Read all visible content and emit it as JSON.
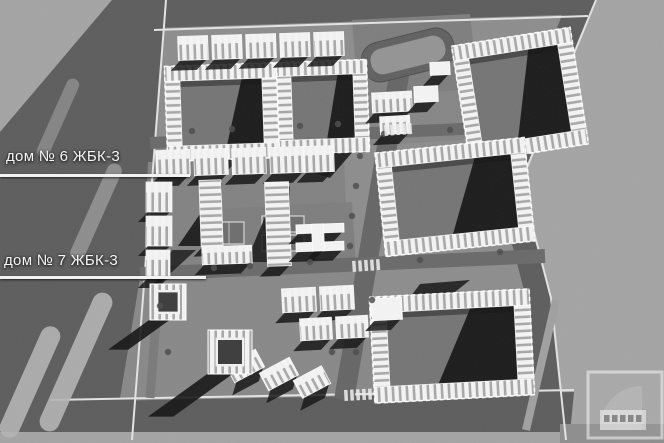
{
  "labels": {
    "house6": "дом № 6 ЖБК-3",
    "house7": "дом № 7 ЖБК-3"
  },
  "palette": {
    "bg": "#a4a4a4",
    "site": "#8d8d8d",
    "plot": "#7e7e7e",
    "road": "#5d5d5d",
    "roadStripe": "#b4b4b4",
    "sidewalk": "#e3e3e3",
    "courtyard": "#757575",
    "shadow": "#151515",
    "building": "#f4f4f4",
    "stripeDark": "#a8a8a8",
    "stadiumRing": "#616161",
    "stadiumField": "#949494",
    "courtFill": "#6e6e6e",
    "courtLine": "#d6d6d6",
    "tree": "#4c4c4c",
    "label": "#f7f7f7"
  },
  "scene": {
    "polys": [
      {
        "pts": [
          [
            0,
            0
          ],
          [
            664,
            0
          ],
          [
            664,
            443
          ],
          [
            0,
            443
          ]
        ],
        "fill": "site"
      },
      {
        "pts": [
          [
            596,
            0
          ],
          [
            664,
            0
          ],
          [
            664,
            443
          ],
          [
            566,
            443
          ],
          [
            551,
            298
          ],
          [
            521,
            182
          ]
        ],
        "fill": "bg"
      },
      {
        "pts": [
          [
            0,
            0
          ],
          [
            112,
            0
          ],
          [
            0,
            132
          ]
        ],
        "fill": "bg"
      },
      {
        "pts": [
          [
            112,
            0
          ],
          [
            166,
            0
          ],
          [
            132,
            443
          ],
          [
            0,
            443
          ],
          [
            0,
            132
          ]
        ],
        "fill": "road"
      },
      {
        "pts": [
          [
            166,
            0
          ],
          [
            596,
            0
          ],
          [
            588,
            14
          ],
          [
            154,
            28
          ]
        ],
        "fill": "road"
      },
      {
        "pts": [
          [
            50,
            402
          ],
          [
            574,
            392
          ],
          [
            570,
            434
          ],
          [
            36,
            434
          ]
        ],
        "fill": "road"
      },
      {
        "pts": [
          [
            568,
            0
          ],
          [
            596,
            0
          ],
          [
            521,
            182
          ],
          [
            551,
            298
          ],
          [
            566,
            434
          ],
          [
            541,
            434
          ],
          [
            526,
            298
          ],
          [
            496,
            182
          ]
        ],
        "fill": "road"
      },
      {
        "pts": [
          [
            0,
            432
          ],
          [
            664,
            432
          ],
          [
            664,
            443
          ],
          [
            0,
            443
          ]
        ],
        "fill": "bg"
      },
      {
        "pts": [
          [
            560,
            424
          ],
          [
            664,
            424
          ],
          [
            664,
            443
          ],
          [
            560,
            443
          ]
        ],
        "fill": "#8e8e8e"
      },
      {
        "pts": [
          [
            352,
            20
          ],
          [
            470,
            14
          ],
          [
            478,
            90
          ],
          [
            358,
            96
          ]
        ],
        "fill": "plot"
      },
      {
        "pts": [
          [
            358,
            96
          ],
          [
            460,
            90
          ],
          [
            466,
            140
          ],
          [
            362,
            146
          ]
        ],
        "fill": "#868686"
      },
      {
        "pts": [
          [
            148,
            162
          ],
          [
            344,
            154
          ],
          [
            348,
            262
          ],
          [
            144,
            270
          ]
        ],
        "fill": "#828282"
      },
      {
        "pts": [
          [
            200,
            210
          ],
          [
            352,
            202
          ],
          [
            356,
            264
          ],
          [
            204,
            272
          ]
        ],
        "fill": "plot"
      },
      {
        "pts": [
          [
            140,
            278
          ],
          [
            370,
            268
          ],
          [
            372,
            396
          ],
          [
            120,
            398
          ]
        ],
        "fill": "#888888"
      }
    ],
    "lines": [
      {
        "p": [
          166,
          0,
          132,
          440
        ],
        "s": "sidewalk",
        "w": 2
      },
      {
        "p": [
          154,
          30,
          588,
          16
        ],
        "s": "sidewalk",
        "w": 2
      },
      {
        "p": [
          50,
          400,
          574,
          390
        ],
        "s": "sidewalk",
        "w": 2
      },
      {
        "p": [
          596,
          0,
          521,
          182
        ],
        "s": "sidewalk",
        "w": 2
      },
      {
        "p": [
          521,
          182,
          551,
          298
        ],
        "s": "sidewalk",
        "w": 2
      },
      {
        "p": [
          551,
          298,
          566,
          440
        ],
        "s": "sidewalk",
        "w": 2
      },
      {
        "p": [
          402,
          58,
          344,
          400
        ],
        "s": "#666666",
        "w": 20
      },
      {
        "p": [
          150,
          143,
          528,
          126
        ],
        "s": "#6a6a6a",
        "w": 12
      },
      {
        "p": [
          140,
          274,
          545,
          256
        ],
        "s": "#6a6a6a",
        "w": 14
      },
      {
        "p": [
          556,
          300,
          526,
          430
        ],
        "s": "#a0a0a0",
        "w": 8
      },
      {
        "p": [
          160,
          268,
          150,
          398
        ],
        "s": "#7a7a7a",
        "w": 9
      }
    ],
    "stripes": [
      {
        "cx": 30,
        "cy": 382,
        "w": 20,
        "h": 120,
        "rot": 24,
        "op": 0.9
      },
      {
        "cx": 76,
        "cy": 362,
        "w": 20,
        "h": 150,
        "rot": 24,
        "op": 0.9
      },
      {
        "cx": 96,
        "cy": 212,
        "w": 15,
        "h": 105,
        "rot": 24,
        "op": 0.55
      },
      {
        "cx": 58,
        "cy": 118,
        "w": 13,
        "h": 85,
        "rot": 24,
        "op": 0.45
      }
    ],
    "stadium": {
      "cx": 408,
      "cy": 55,
      "w": 94,
      "h": 40,
      "rot": -14
    },
    "courts": [
      {
        "x": 214,
        "y": 222,
        "w": 30,
        "h": 22
      },
      {
        "x": 262,
        "y": 216,
        "w": 42,
        "h": 16
      },
      {
        "x": 262,
        "y": 235,
        "w": 42,
        "h": 16
      }
    ],
    "shadows": [
      {
        "pts": [
          [
            222,
            182
          ],
          [
            222,
            246
          ],
          [
            178,
            246
          ]
        ],
        "op": 0.9
      },
      {
        "pts": [
          [
            290,
            186
          ],
          [
            290,
            262
          ],
          [
            246,
            262
          ],
          [
            268,
            210
          ]
        ],
        "op": 0.85
      },
      {
        "pts": [
          [
            172,
            250
          ],
          [
            196,
            250
          ],
          [
            150,
            292
          ]
        ],
        "op": 0.8
      },
      {
        "pts": [
          [
            310,
            152
          ],
          [
            356,
            148
          ],
          [
            330,
            178
          ],
          [
            306,
            170
          ]
        ],
        "op": 0.85
      },
      {
        "pts": [
          [
            208,
            154
          ],
          [
            246,
            152
          ],
          [
            226,
            172
          ]
        ],
        "op": 0.8
      },
      {
        "pts": [
          [
            420,
            284
          ],
          [
            470,
            280
          ],
          [
            440,
            304
          ],
          [
            408,
            300
          ]
        ],
        "op": 0.85
      }
    ],
    "rings": [
      {
        "cx": 222,
        "cy": 112,
        "w": 112,
        "h": 95,
        "t": 15,
        "rot": -2,
        "sh": 0.45
      },
      {
        "cx": 323,
        "cy": 107,
        "w": 90,
        "h": 92,
        "t": 14,
        "rot": -2,
        "sh": 0.45
      },
      {
        "cx": 520,
        "cy": 95,
        "w": 120,
        "h": 118,
        "t": 15,
        "rot": -9,
        "sh": 0.6
      },
      {
        "cx": 455,
        "cy": 197,
        "w": 150,
        "h": 104,
        "t": 15,
        "rot": -6,
        "sh": 0.55
      },
      {
        "cx": 452,
        "cy": 346,
        "w": 160,
        "h": 106,
        "t": 16,
        "rot": -3,
        "sh": 0.62
      }
    ],
    "slabs": [
      {
        "x": 178,
        "y": 36,
        "w": 30,
        "h": 24,
        "rot": -2
      },
      {
        "x": 212,
        "y": 35,
        "w": 30,
        "h": 24,
        "rot": -2
      },
      {
        "x": 246,
        "y": 34,
        "w": 30,
        "h": 24,
        "rot": -2
      },
      {
        "x": 280,
        "y": 33,
        "w": 30,
        "h": 24,
        "rot": -2
      },
      {
        "x": 314,
        "y": 32,
        "w": 30,
        "h": 24,
        "rot": -2
      },
      {
        "x": 372,
        "y": 92,
        "w": 40,
        "h": 20,
        "rot": -3
      },
      {
        "x": 414,
        "y": 86,
        "w": 24,
        "h": 16,
        "rot": -3,
        "face": "p"
      },
      {
        "x": 380,
        "y": 116,
        "w": 30,
        "h": 18,
        "rot": -3
      },
      {
        "x": 430,
        "y": 62,
        "w": 20,
        "h": 13,
        "rot": -3,
        "face": "p"
      },
      {
        "x": 156,
        "y": 150,
        "w": 34,
        "h": 26,
        "rot": -2
      },
      {
        "x": 194,
        "y": 149,
        "w": 34,
        "h": 26,
        "rot": -2
      },
      {
        "x": 232,
        "y": 148,
        "w": 34,
        "h": 26,
        "rot": -2
      },
      {
        "x": 270,
        "y": 147,
        "w": 34,
        "h": 26,
        "rot": -2
      },
      {
        "x": 304,
        "y": 146,
        "w": 30,
        "h": 26,
        "rot": -2
      },
      {
        "x": 146,
        "y": 182,
        "w": 26,
        "h": 30,
        "rot": 0
      },
      {
        "x": 146,
        "y": 216,
        "w": 26,
        "h": 30,
        "rot": 0
      },
      {
        "x": 146,
        "y": 250,
        "w": 24,
        "h": 28,
        "rot": 0
      },
      {
        "x": 200,
        "y": 180,
        "w": 22,
        "h": 66,
        "rot": -2,
        "face": "v"
      },
      {
        "x": 202,
        "y": 246,
        "w": 50,
        "h": 18,
        "rot": -2
      },
      {
        "x": 266,
        "y": 182,
        "w": 24,
        "h": 84,
        "rot": -2,
        "face": "v"
      },
      {
        "x": 282,
        "y": 288,
        "w": 34,
        "h": 24,
        "rot": -3
      },
      {
        "x": 320,
        "y": 286,
        "w": 34,
        "h": 24,
        "rot": -3
      },
      {
        "x": 300,
        "y": 318,
        "w": 32,
        "h": 22,
        "rot": -3
      },
      {
        "x": 336,
        "y": 316,
        "w": 32,
        "h": 22,
        "rot": -3
      },
      {
        "x": 228,
        "y": 356,
        "w": 34,
        "h": 20,
        "rot": -28
      },
      {
        "x": 262,
        "y": 364,
        "w": 34,
        "h": 20,
        "rot": -28
      },
      {
        "x": 296,
        "y": 372,
        "w": 32,
        "h": 20,
        "rot": -28
      },
      {
        "x": 372,
        "y": 298,
        "w": 30,
        "h": 22,
        "rot": -3,
        "face": "p"
      },
      {
        "x": 296,
        "y": 224,
        "w": 48,
        "h": 9,
        "rot": -2,
        "face": "p"
      },
      {
        "x": 296,
        "y": 242,
        "w": 48,
        "h": 9,
        "rot": -2,
        "face": "p"
      },
      {
        "x": 312,
        "y": 224,
        "w": 12,
        "h": 27,
        "rot": -2,
        "face": "p"
      }
    ],
    "towers": [
      {
        "x": 150,
        "y": 284,
        "s": 36,
        "shl": 44
      },
      {
        "x": 208,
        "y": 330,
        "s": 44,
        "shl": 62
      }
    ],
    "trees": [
      [
        192,
        131
      ],
      [
        232,
        129
      ],
      [
        300,
        126
      ],
      [
        338,
        124
      ],
      [
        360,
        156
      ],
      [
        356,
        186
      ],
      [
        352,
        216
      ],
      [
        350,
        246
      ],
      [
        214,
        268
      ],
      [
        250,
        266
      ],
      [
        310,
        262
      ],
      [
        420,
        260
      ],
      [
        500,
        252
      ],
      [
        160,
        306
      ],
      [
        168,
        352
      ],
      [
        332,
        352
      ],
      [
        356,
        352
      ],
      [
        384,
        134
      ],
      [
        450,
        130
      ],
      [
        372,
        300
      ]
    ],
    "crosswalks": [
      {
        "x": 384,
        "y": 125,
        "rot": -4
      },
      {
        "x": 352,
        "y": 261,
        "rot": -4
      },
      {
        "x": 344,
        "y": 390,
        "rot": -3
      }
    ],
    "logo": {
      "x": 588,
      "y": 372,
      "w": 74,
      "h": 66
    }
  }
}
